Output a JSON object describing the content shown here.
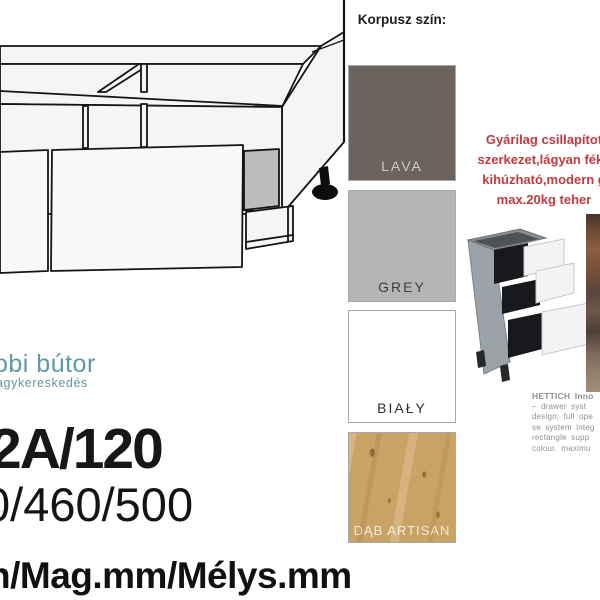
{
  "color_panel": {
    "header": "Korpusz szín:",
    "swatches": [
      {
        "id": "lava",
        "label": "LAVA",
        "bg": "#6b635d",
        "label_color": "#cfc9c3"
      },
      {
        "id": "grey",
        "label": "GREY",
        "bg": "#b5b5b5",
        "label_color": "#3f3f3f"
      },
      {
        "id": "bialy",
        "label": "BIAŁY",
        "bg": "#ffffff",
        "label_color": "#2e2e2e"
      },
      {
        "id": "dab-artisan",
        "label": "DĄB ARTISAN",
        "bg": "#c9a266",
        "label_color": "#f3ecd8"
      }
    ]
  },
  "promo": {
    "color": "#c03a40",
    "lines": [
      "Gyárilag csillapítot",
      "szerkezet,lágyan féke",
      "kihúzható,modern g",
      "max.20kg teher"
    ]
  },
  "hettich": {
    "color": "#8f8f8f",
    "title": "HETTICH Inno",
    "lines": [
      "–  drawer  syst",
      "design, full ope",
      "se system integ",
      "rectangle  supp",
      "colour.  maximu"
    ]
  },
  "logo": {
    "name": "obi bútor",
    "tagline": "agykereskedés",
    "color": "#5f9aa0"
  },
  "product": {
    "code": "2A/120",
    "dimensions": "0/460/500",
    "dimension_caption": "n/Mag.mm/Mélys.mm"
  },
  "images": {
    "technical_drawing": "wide-base-cabinet-line-drawing",
    "render": "three-drawer-cabinet-render",
    "wood_strip": "wood-panel-photo-edge"
  }
}
